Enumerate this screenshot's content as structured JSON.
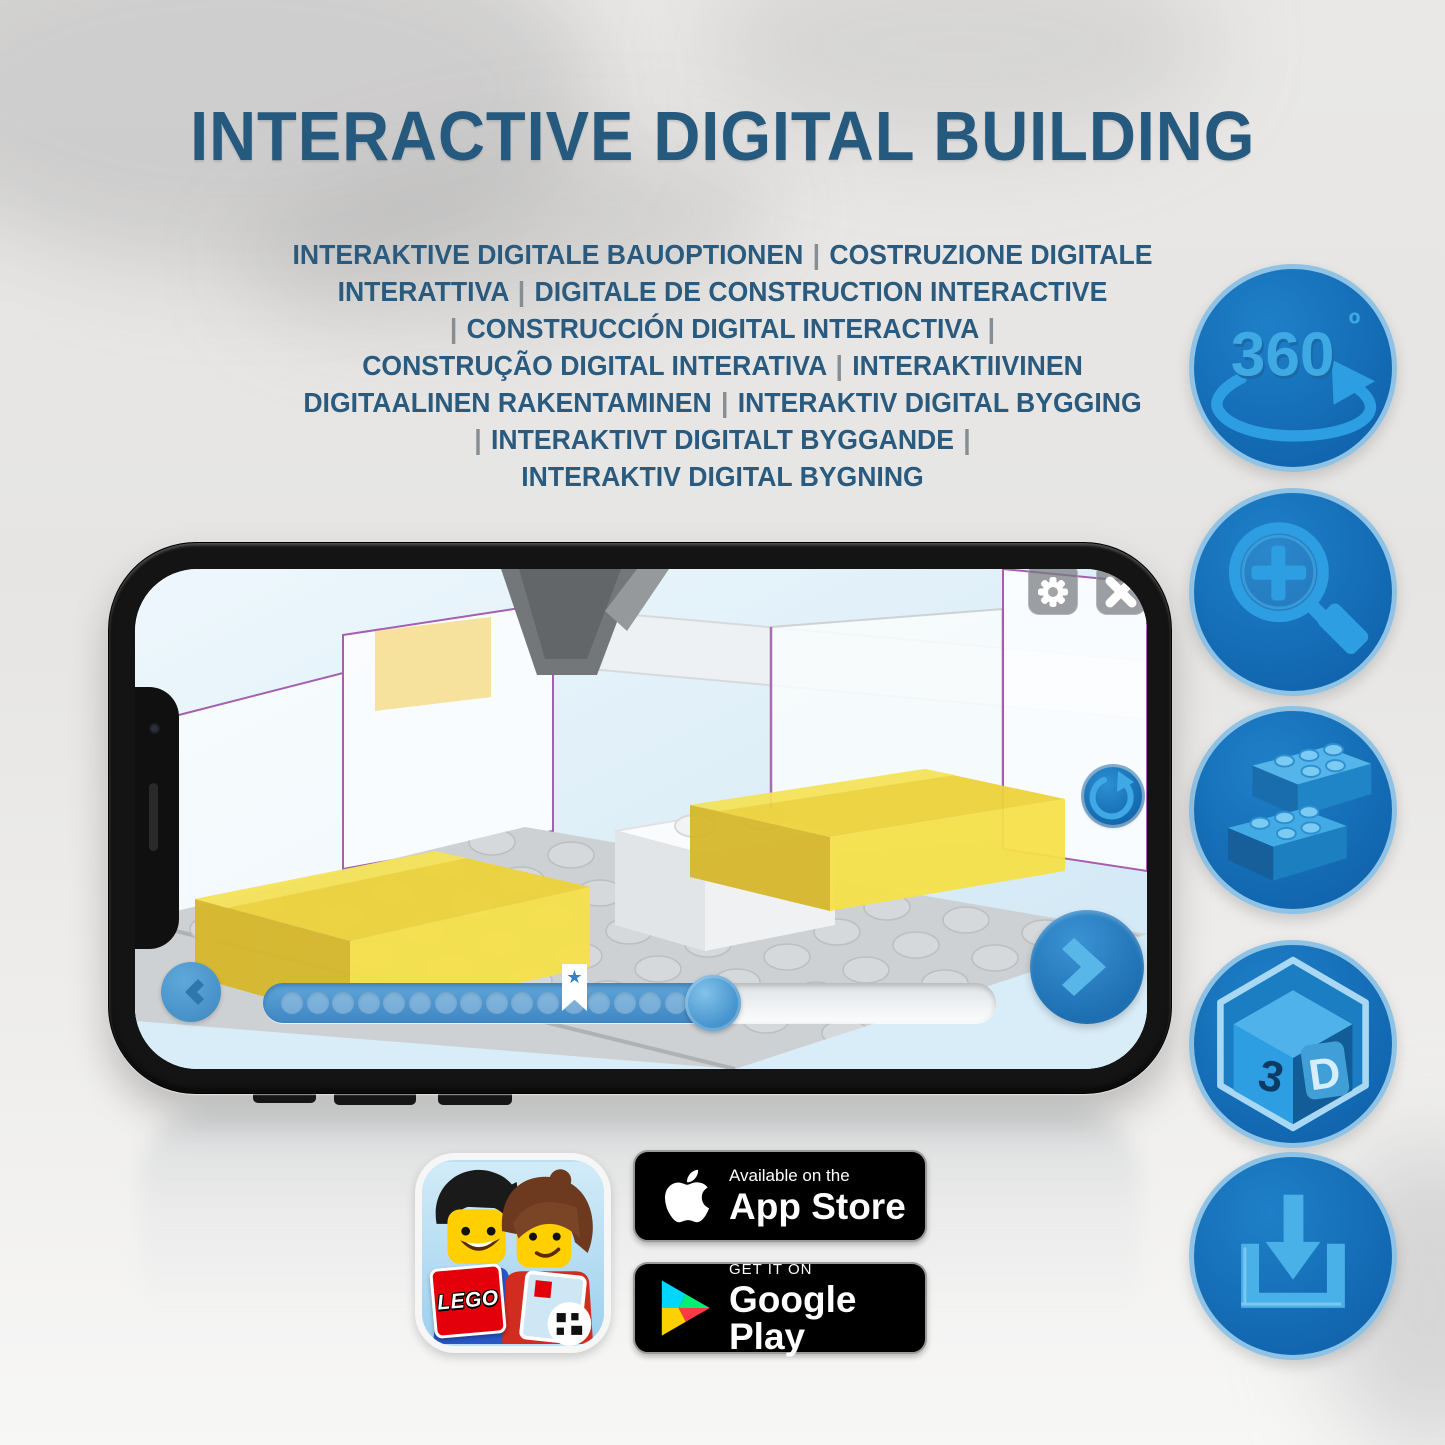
{
  "page": {
    "title": "INTERACTIVE DIGITAL BUILDING",
    "subtitle_lines": [
      "INTERAKTIVE DIGITALE BAUOPTIONEN | COSTRUZIONE DIGITALE",
      "INTERATTIVA | DIGITALE DE CONSTRUCTION INTERACTIVE",
      "| CONSTRUCCIÓN DIGITAL INTERACTIVA |",
      "CONSTRUÇÃO DIGITAL INTERATIVA | INTERAKTIIVINEN",
      "DIGITAALINEN RAKENTAMINEN | INTERAKTIV DIGITAL BYGGING",
      "| INTERAKTIVT DIGITALT BYGGANDE |",
      "INTERAKTIV DIGITAL BYGNING"
    ]
  },
  "feature_icons": [
    {
      "id": "rotate-360-icon",
      "label": "360",
      "degree": "º"
    },
    {
      "id": "zoom-in-icon"
    },
    {
      "id": "stacking-bricks-icon"
    },
    {
      "id": "cube-3d-icon",
      "face_left": "3",
      "face_right": "D"
    },
    {
      "id": "download-icon"
    }
  ],
  "phone_app": {
    "toolbar_icons": [
      "gear",
      "close"
    ],
    "control_icons": [
      "rotate-refresh",
      "back-chevron",
      "next-chevron"
    ],
    "progress": {
      "dots_total": 17,
      "filled_ratio": 0.63,
      "bookmark_star": "★"
    }
  },
  "store_badges": {
    "lego_app": {
      "logo_text": "LEGO"
    },
    "app_store": {
      "tagline": "Available on the",
      "store_name": "App Store"
    },
    "google_play": {
      "tagline": "GET IT ON",
      "store_name": "Google Play"
    }
  },
  "colors": {
    "title_blue": "#25597e",
    "circle_blue": "#1268b1",
    "circle_border_blue": "#8fc3e6",
    "icon_glyph_blue": "#2d9ee1",
    "progress_blue": "#4a90c8",
    "brick_highlight_yellow": "#f2d83c",
    "badge_black": "#000000"
  }
}
